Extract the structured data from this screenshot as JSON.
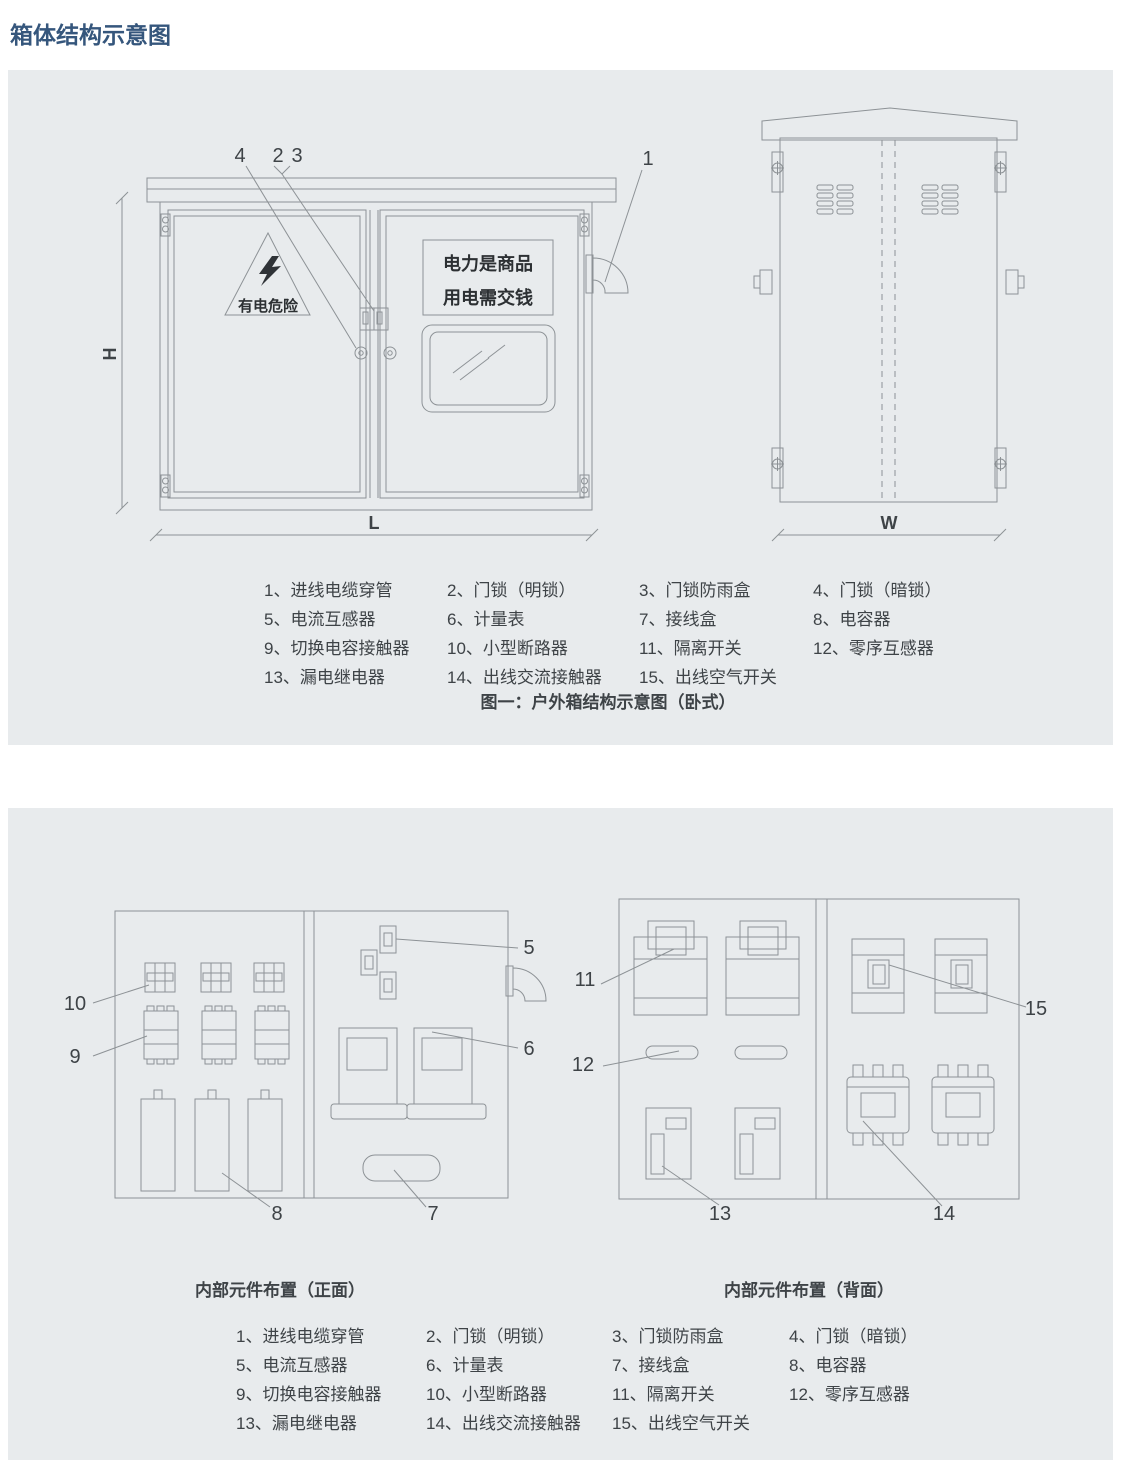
{
  "title": "箱体结构示意图",
  "legend": {
    "items": [
      "1、进线电缆穿管",
      "2、门锁（明锁）",
      "3、门锁防雨盒",
      "4、门锁（暗锁）",
      "5、电流互感器",
      "6、计量表",
      "7、接线盒",
      "8、电容器",
      "9、切换电容接触器",
      "10、小型断路器",
      "11、隔离开关",
      "12、零序互感器",
      "13、漏电继电器",
      "14、出线交流接触器",
      "15、出线空气开关"
    ]
  },
  "figure1": {
    "caption": "图一：户外箱结构示意图（卧式）",
    "warning_text": "有电危险",
    "sign_line1": "电力是商品",
    "sign_line2": "用电需交钱",
    "dim_height": "H",
    "dim_length": "L",
    "dim_width": "W"
  },
  "figure2": {
    "front_label": "内部元件布置（正面）",
    "back_label": "内部元件布置（背面）"
  },
  "callouts": {
    "n1": "1",
    "n2": "2",
    "n3": "3",
    "n4": "4",
    "n5": "5",
    "n6": "6",
    "n7": "7",
    "n8": "8",
    "n9": "9",
    "n10": "10",
    "n11": "11",
    "n12": "12",
    "n13": "13",
    "n14": "14",
    "n15": "15"
  },
  "colors": {
    "panel_bg": "#e8ebed",
    "line": "#8d9296",
    "title": "#35567c",
    "text": "#3e4347"
  }
}
